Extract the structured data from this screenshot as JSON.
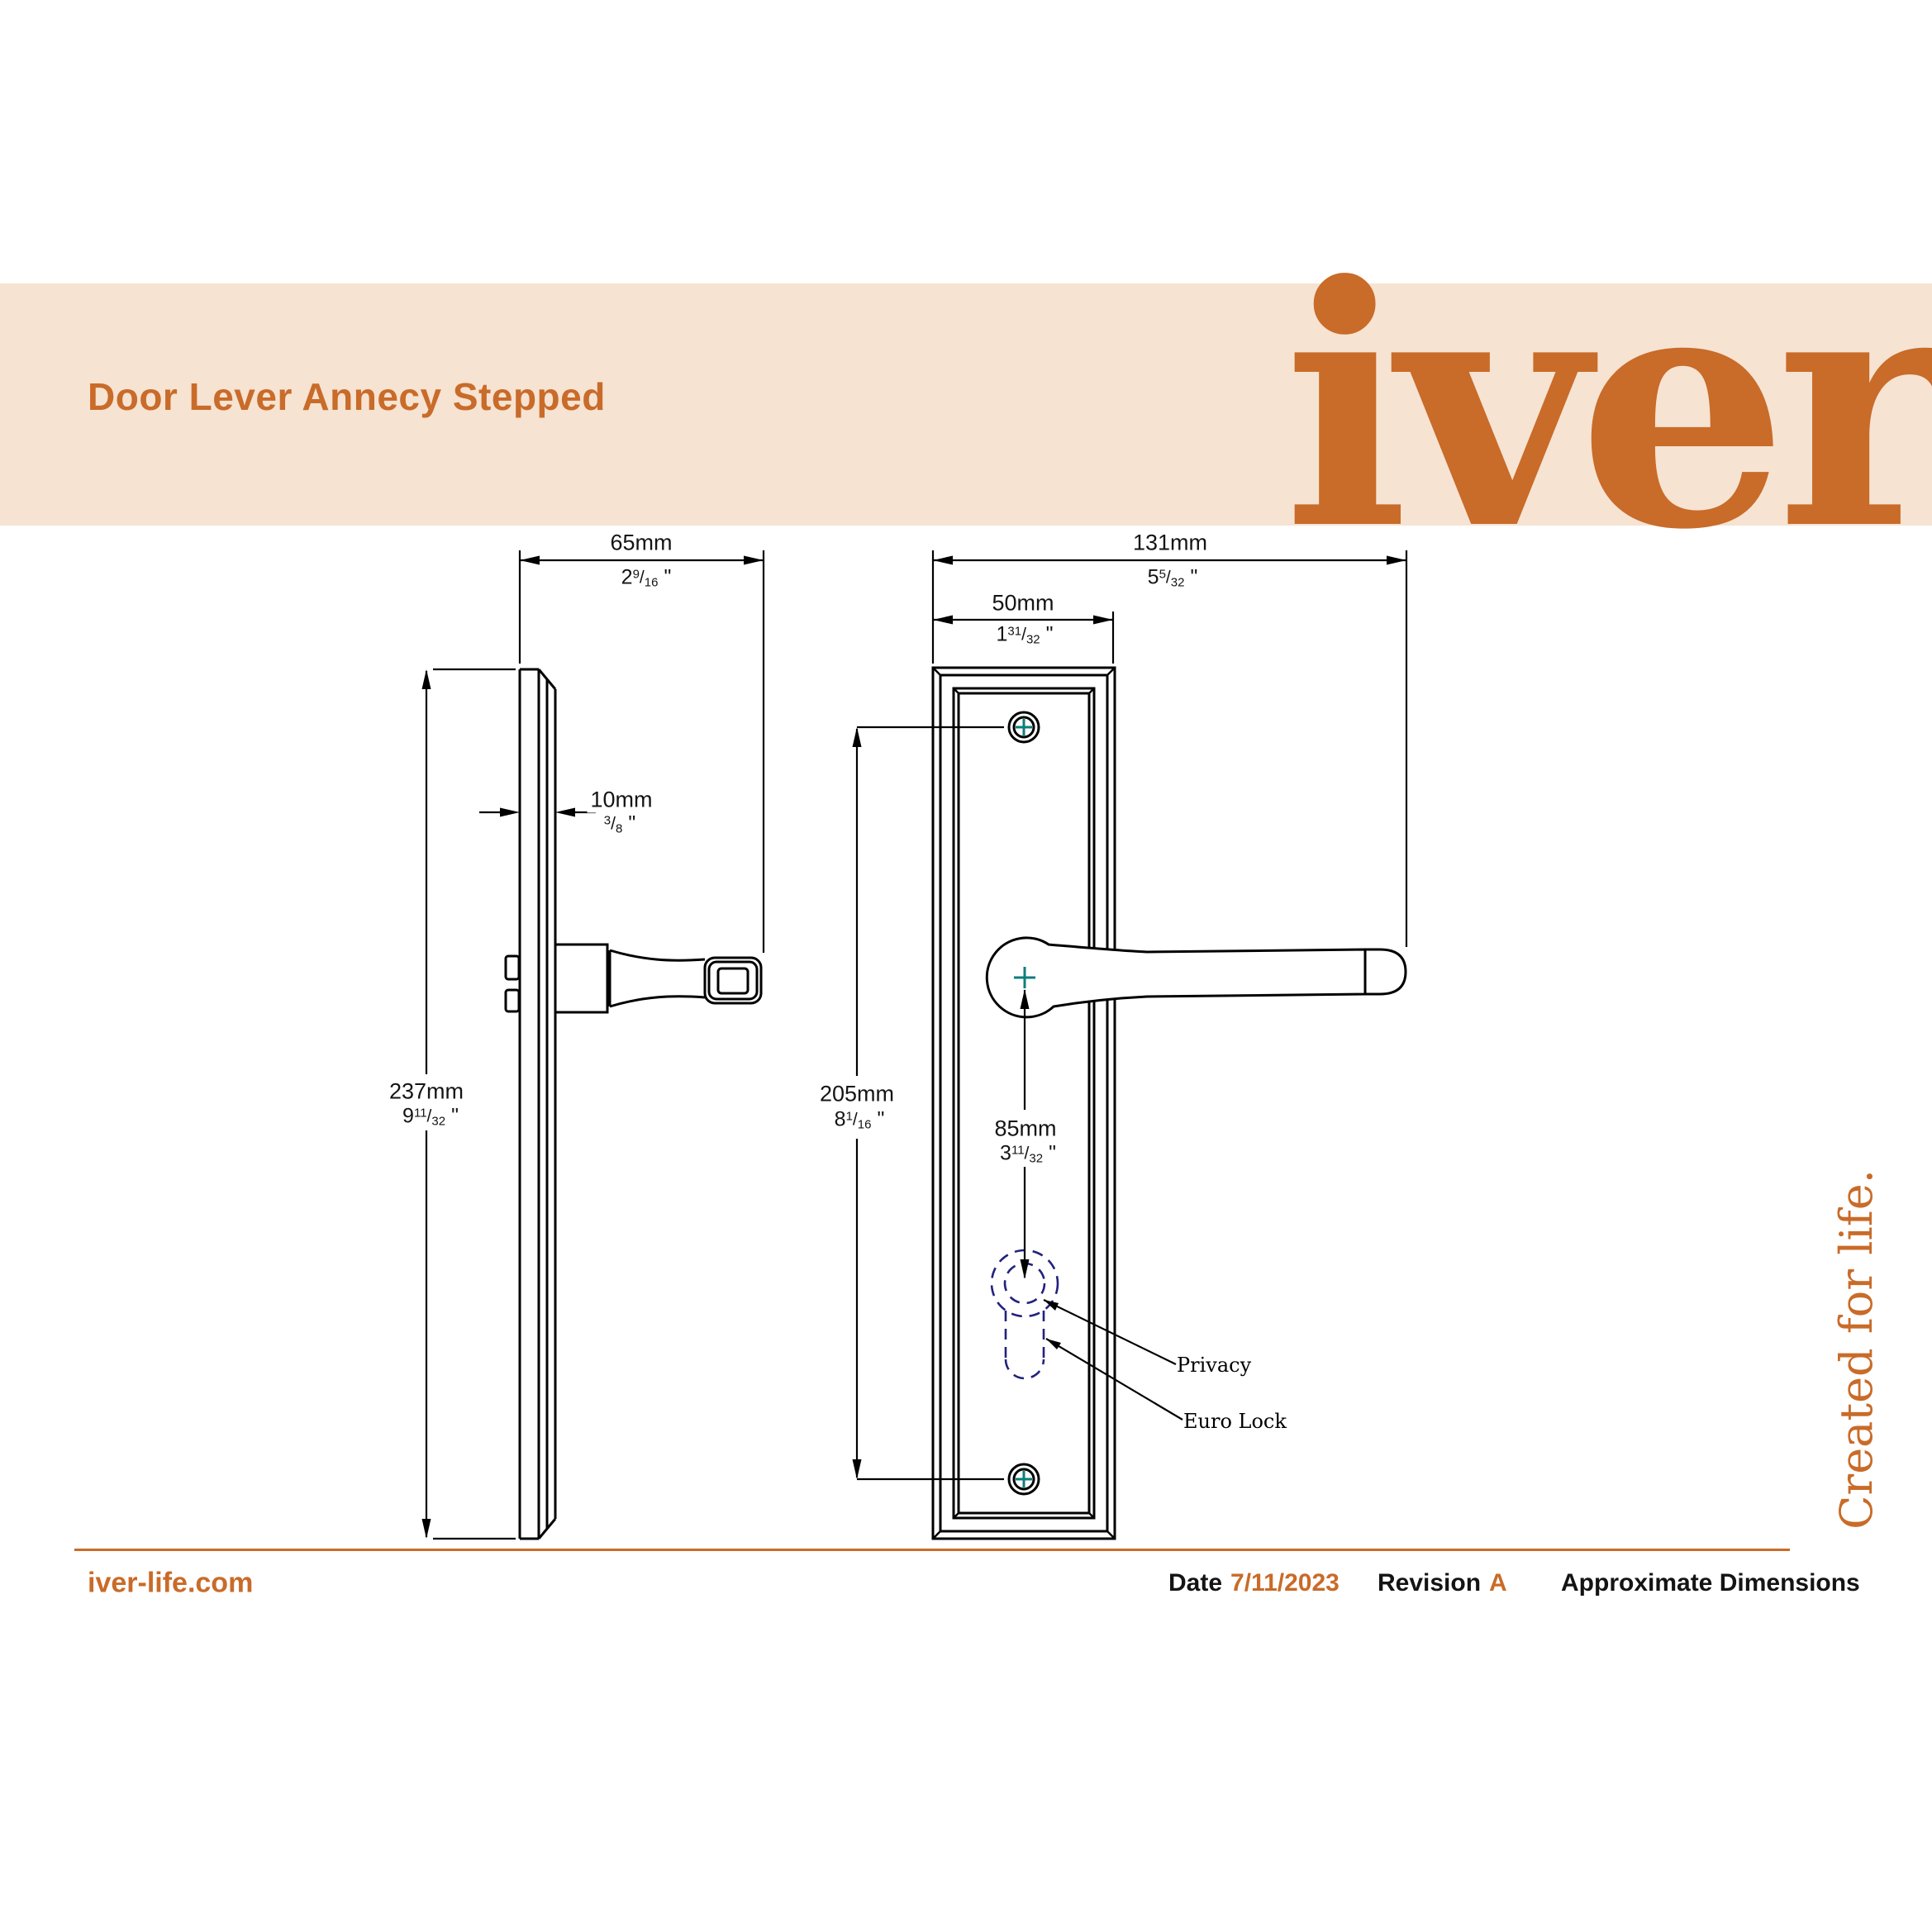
{
  "ui": {
    "slash": "/"
  },
  "colors": {
    "accent": "#c96b29",
    "band": "#f6e3d2",
    "ink": "#141414",
    "teal": "#0f7d7d",
    "navy": "#22227d"
  },
  "header": {
    "title": "Door Lever Annecy Stepped",
    "logo": "iver",
    "tagline": "Created for life."
  },
  "dimensions": {
    "projection": {
      "mm": "65mm",
      "whole": "2",
      "num": "9",
      "den": "16",
      "unit": "\""
    },
    "plate_thickness": {
      "mm": "10mm",
      "whole": "",
      "num": "3",
      "den": "8",
      "unit": "\""
    },
    "plate_height": {
      "mm": "237mm",
      "whole": "9",
      "num": "11",
      "den": "32",
      "unit": "\""
    },
    "overall_width": {
      "mm": "131mm",
      "whole": "5",
      "num": "5",
      "den": "32",
      "unit": "\""
    },
    "plate_width": {
      "mm": "50mm",
      "whole": "1",
      "num": "31",
      "den": "32",
      "unit": "\""
    },
    "fixing_centres": {
      "mm": "205mm",
      "whole": "8",
      "num": "1",
      "den": "16",
      "unit": "\""
    },
    "lever_to_cylinder": {
      "mm": "85mm",
      "whole": "3",
      "num": "11",
      "den": "32",
      "unit": "\""
    }
  },
  "callouts": {
    "privacy": "Privacy",
    "euro_lock": "Euro Lock"
  },
  "footer": {
    "website": "iver-life.com",
    "date_label": "Date",
    "date_value": "7/11/2023",
    "revision_label": "Revision",
    "revision_value": "A",
    "note": "Approximate Dimensions"
  }
}
